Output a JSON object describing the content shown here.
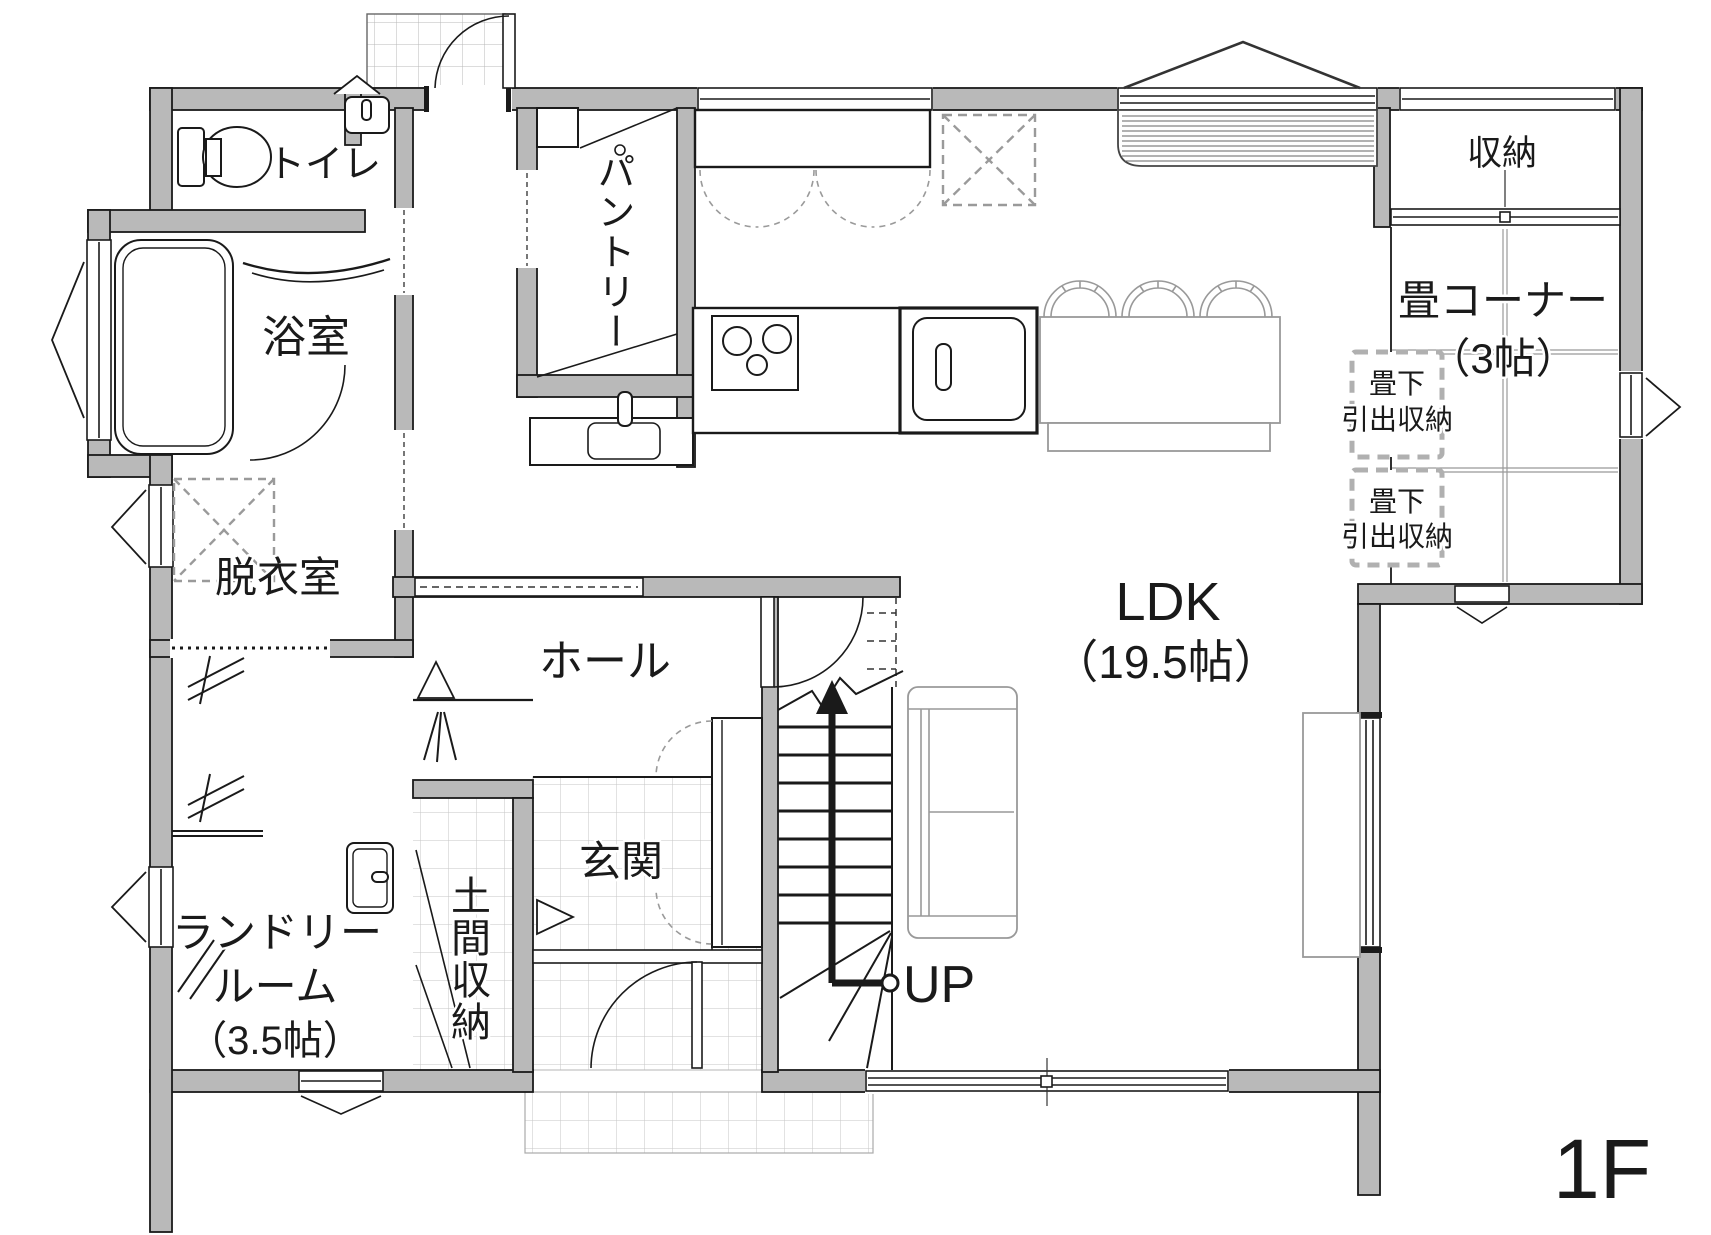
{
  "floor_label": "1F",
  "colors": {
    "wall": "#b9b9b9",
    "outline": "#1a1a1a",
    "furniture_gray": "#999999",
    "tile_line": "#c6c6c6",
    "storage_dash": "#b0b0b0",
    "background": "#ffffff"
  },
  "rooms": {
    "toilet": {
      "label": "トイレ"
    },
    "bath": {
      "label": "浴室"
    },
    "changing": {
      "label": "脱衣室"
    },
    "laundry": {
      "label_line1": "ランドリー",
      "label_line2": "ルーム",
      "label_line3": "（3.5帖）"
    },
    "pantry": {
      "label": "パントリー"
    },
    "hall": {
      "label": "ホール"
    },
    "entrance": {
      "label": "玄関"
    },
    "doma": {
      "label": "土間収納"
    },
    "ldk": {
      "label": "LDK",
      "size": "（19.5帖）"
    },
    "storage": {
      "label": "収納"
    },
    "tatami": {
      "label": "畳コーナー",
      "size": "（3帖）"
    },
    "under_tatami_1": {
      "line1": "畳下",
      "line2": "引出収納"
    },
    "under_tatami_2": {
      "line1": "畳下",
      "line2": "引出収納"
    }
  },
  "stairs": {
    "up_label": "UP"
  }
}
